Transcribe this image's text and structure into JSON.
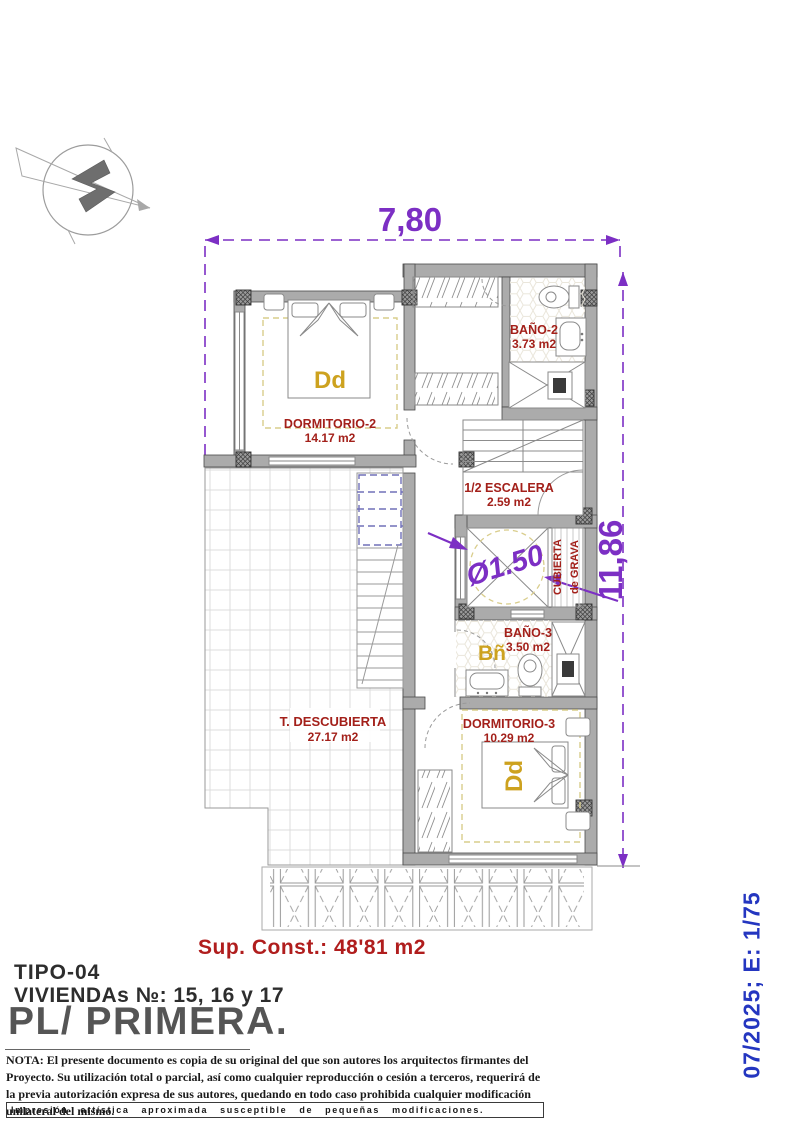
{
  "plan": {
    "dimensions": {
      "width": "7,80",
      "height": "11,86",
      "patio_diameter": "Ø1.50"
    },
    "rooms": {
      "dormitorio2": {
        "name": "DORMITORIO-2",
        "area": "14.17 m2",
        "tag": "Dd"
      },
      "bano2": {
        "name": "BAÑO-2",
        "area": "3.73 m2"
      },
      "escalera": {
        "name": "1/2 ESCALERA",
        "area": "2.59 m2"
      },
      "cubierta_grava": {
        "line1": "CUBIERTA",
        "line2": "de GRAVA"
      },
      "bano3": {
        "name": "BAÑO-3",
        "area": "3.50 m2",
        "tag": "Bñ"
      },
      "dormitorio3": {
        "name": "DORMITORIO-3",
        "area": "10.29 m2",
        "tag": "Dd"
      },
      "terraza": {
        "name": "T. DESCUBIERTA",
        "area": "27.17 m2"
      }
    }
  },
  "title_block": {
    "built_area": "Sup. Const.: 48'81 m2",
    "type_label": "TIPO-04",
    "units_label": "VIVIENDAs №: 15, 16 y 17",
    "floor_label": "PL/ PRIMERA.",
    "note": "NOTA: El presente documento es copia de su original del que son autores los arquitectos firmantes del Proyecto. Su utilización total o parcial, así como cualquier reproducción o cesión a terceros, requerirá  de la previa autorización expresa de sus autores, quedando en todo caso prohibida cualquier modificación unilateral del mismo.",
    "disclaimer": "Impresión artística aproximada susceptible de pequeñas modificaciones.",
    "date_scale": "07/2025; E: 1/75"
  },
  "colors": {
    "dimension_purple": "#7c2fc4",
    "room_label_red": "#a3201a",
    "tag_gold": "#cda21f",
    "date_blue": "#2436c0",
    "wall_gray": "#ababab"
  }
}
